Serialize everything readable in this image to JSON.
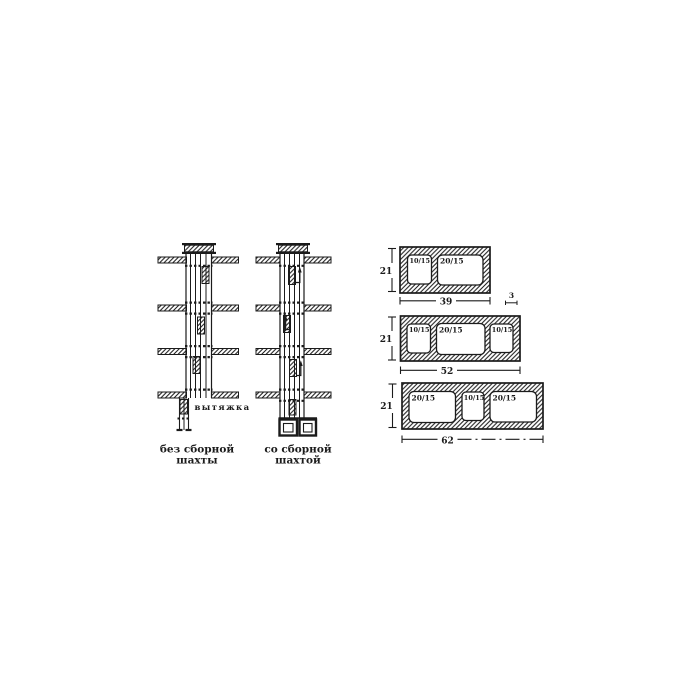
{
  "figure": {
    "background": "#ffffff",
    "ink": "#1b1b1b"
  },
  "shaft_diagrams": {
    "exhaust_label": "вытяжка",
    "without_collector": {
      "caption_line1": "без сборной",
      "caption_line2": "шахты"
    },
    "with_collector": {
      "caption_line1": "со сборной",
      "caption_line2": "шахтой"
    }
  },
  "block_sections": [
    {
      "height_dim": "21",
      "width_dim": "39",
      "wall_dim": "3",
      "openings": [
        "10/15",
        "20/15"
      ]
    },
    {
      "height_dim": "21",
      "width_dim": "52",
      "openings": [
        "10/15",
        "20/15",
        "10/15"
      ]
    },
    {
      "height_dim": "21",
      "width_dim": "62",
      "openings": [
        "20/15",
        "10/15",
        "20/15"
      ]
    }
  ]
}
